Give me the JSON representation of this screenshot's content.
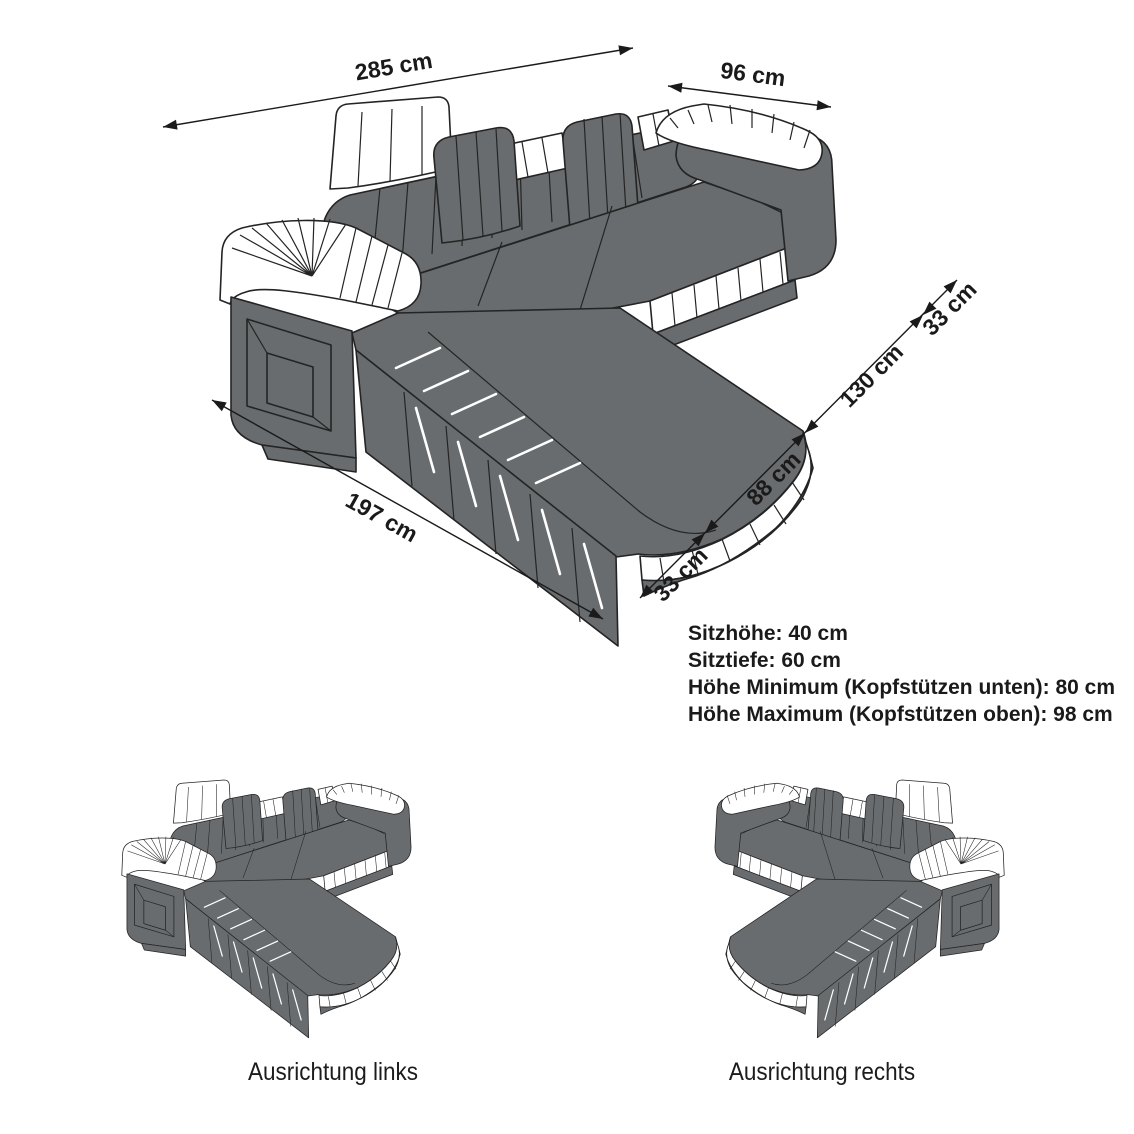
{
  "diagram": {
    "title": "corner-sofa-dimension-diagram",
    "dimensions": {
      "total_width": "285 cm",
      "arm_depth": "96 cm",
      "chaise_length": "197 cm",
      "segment_bottom": "33 cm",
      "segment_seat": "88 cm",
      "segment_chaise": "130 cm",
      "segment_top": "33 cm"
    },
    "specs": {
      "line1": "Sitzhöhe: 40 cm",
      "line2": "Sitztiefe: 60 cm",
      "line3": "Höhe Minimum (Kopfstützen unten): 80 cm",
      "line4": "Höhe Maximum (Kopfstützen oben): 98 cm"
    },
    "variants": {
      "left_label": "Ausrichtung links",
      "right_label": "Ausrichtung rechts"
    },
    "colors": {
      "sofa_body": "#696c6e",
      "outline": "#242424",
      "accent_white": "#ffffff",
      "text": "#1a1a1a",
      "background": "#ffffff"
    }
  }
}
